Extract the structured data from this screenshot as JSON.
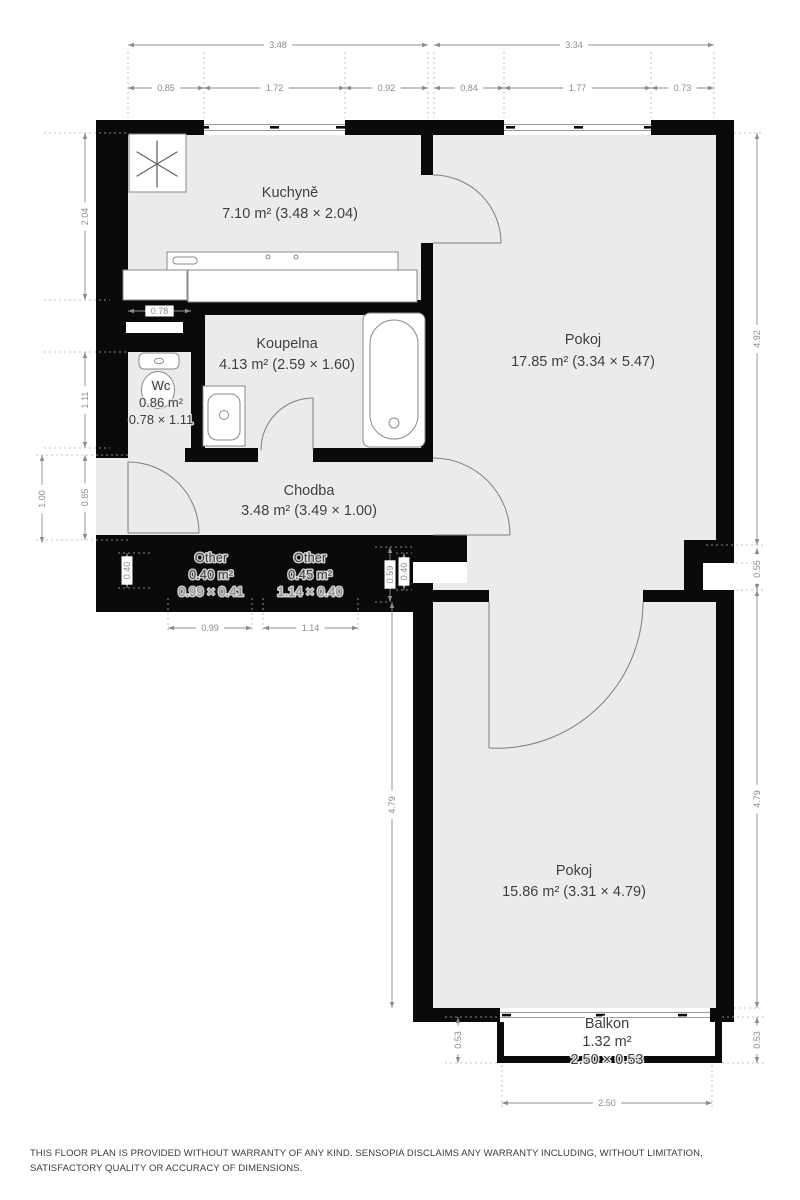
{
  "title": "Floor plan",
  "disclaimer": "THIS FLOOR PLAN IS PROVIDED WITHOUT WARRANTY OF ANY KIND. SENSOPIA DISCLAIMS ANY WARRANTY INCLUDING, WITHOUT LIMITATION, SATISFACTORY QUALITY OR ACCURACY OF DIMENSIONS.",
  "colors": {
    "wall": "#0a0a0a",
    "floor": "#ebebeb",
    "dimension": "#8c8c8c",
    "label": "#3e3e3e"
  },
  "rooms": [
    {
      "id": "kuchyne",
      "name": "Kuchyně",
      "lines": [
        "7.10 m² (3.48 × 2.04)"
      ],
      "x": 290,
      "y": 197,
      "pitch": 21,
      "size": "lg"
    },
    {
      "id": "pokoj-horni",
      "name": "Pokoj",
      "lines": [
        "17.85 m² (3.34 × 5.47)"
      ],
      "x": 583,
      "y": 344,
      "pitch": 22,
      "size": "lg"
    },
    {
      "id": "koupelna",
      "name": "Koupelna",
      "lines": [
        "4.13 m² (2.59 × 1.60)"
      ],
      "x": 287,
      "y": 348,
      "pitch": 21,
      "size": "lg"
    },
    {
      "id": "wc",
      "name": "Wc",
      "lines": [
        "0.86 m²",
        "0.78 × 1.11"
      ],
      "x": 161,
      "y": 390,
      "pitch": 17,
      "size": "sm"
    },
    {
      "id": "chodba",
      "name": "Chodba",
      "lines": [
        "3.48 m² (3.49 × 1.00)"
      ],
      "x": 309,
      "y": 495,
      "pitch": 20,
      "size": "lg"
    },
    {
      "id": "other-1",
      "name": "Other",
      "lines": [
        "0.40 m²",
        "0.99 × 0.41"
      ],
      "x": 211,
      "y": 562,
      "pitch": 17,
      "size": "sm",
      "muted_last": true
    },
    {
      "id": "other-2",
      "name": "Other",
      "lines": [
        "0.45 m²",
        "1.14 × 0.40"
      ],
      "x": 310,
      "y": 562,
      "pitch": 17,
      "size": "sm",
      "muted_last": true
    },
    {
      "id": "pokoj-dolni",
      "name": "Pokoj",
      "lines": [
        "15.86 m² (3.31 × 4.79)"
      ],
      "x": 574,
      "y": 875,
      "pitch": 21,
      "size": "lg"
    },
    {
      "id": "balkon",
      "name": "Balkon",
      "lines": [
        "1.32 m²",
        "2.50 × 0.53"
      ],
      "x": 607,
      "y": 1028,
      "pitch": 18,
      "size": "lg"
    }
  ],
  "dimensions": [
    {
      "value": "3.48",
      "x1": 128,
      "y1": 45,
      "x2": 428,
      "y2": 45
    },
    {
      "value": "0.85",
      "x1": 128,
      "y1": 88,
      "x2": 204,
      "y2": 88
    },
    {
      "value": "1.72",
      "x1": 204,
      "y1": 88,
      "x2": 345,
      "y2": 88
    },
    {
      "value": "0.92",
      "x1": 345,
      "y1": 88,
      "x2": 428,
      "y2": 88
    },
    {
      "value": "3.34",
      "x1": 434,
      "y1": 45,
      "x2": 714,
      "y2": 45
    },
    {
      "value": "0.84",
      "x1": 434,
      "y1": 88,
      "x2": 504,
      "y2": 88
    },
    {
      "value": "1.77",
      "x1": 504,
      "y1": 88,
      "x2": 651,
      "y2": 88
    },
    {
      "value": "0.73",
      "x1": 651,
      "y1": 88,
      "x2": 714,
      "y2": 88
    },
    {
      "value": "2.04",
      "x1": 85,
      "y1": 133,
      "x2": 85,
      "y2": 300
    },
    {
      "value": "1.11",
      "x1": 85,
      "y1": 352,
      "x2": 85,
      "y2": 448
    },
    {
      "value": "0.85",
      "x1": 85,
      "y1": 455,
      "x2": 85,
      "y2": 540
    },
    {
      "value": "1.00",
      "x1": 42,
      "y1": 455,
      "x2": 42,
      "y2": 543
    },
    {
      "value": "0.78",
      "x1": 128,
      "y1": 311,
      "x2": 191,
      "y2": 311
    },
    {
      "value": "0.40",
      "x1": 127,
      "y1": 553,
      "x2": 127,
      "y2": 588
    },
    {
      "value": "0.99",
      "x1": 168,
      "y1": 628,
      "x2": 252,
      "y2": 628
    },
    {
      "value": "1.14",
      "x1": 263,
      "y1": 628,
      "x2": 358,
      "y2": 628
    },
    {
      "value": "0.59",
      "x1": 390,
      "y1": 547,
      "x2": 390,
      "y2": 602
    },
    {
      "value": "0.40",
      "x1": 404,
      "y1": 553,
      "x2": 404,
      "y2": 590
    },
    {
      "value": "4.79",
      "x1": 392,
      "y1": 602,
      "x2": 392,
      "y2": 1008
    },
    {
      "value": "4.92",
      "x1": 757,
      "y1": 133,
      "x2": 757,
      "y2": 545
    },
    {
      "value": "0.55",
      "x1": 757,
      "y1": 548,
      "x2": 757,
      "y2": 590
    },
    {
      "value": "4.79",
      "x1": 757,
      "y1": 590,
      "x2": 757,
      "y2": 1008
    },
    {
      "value": "0.53",
      "x1": 458,
      "y1": 1017,
      "x2": 458,
      "y2": 1063
    },
    {
      "value": "0.53",
      "x1": 757,
      "y1": 1017,
      "x2": 757,
      "y2": 1063
    },
    {
      "value": "2.50",
      "x1": 502,
      "y1": 1103,
      "x2": 712,
      "y2": 1103
    }
  ]
}
